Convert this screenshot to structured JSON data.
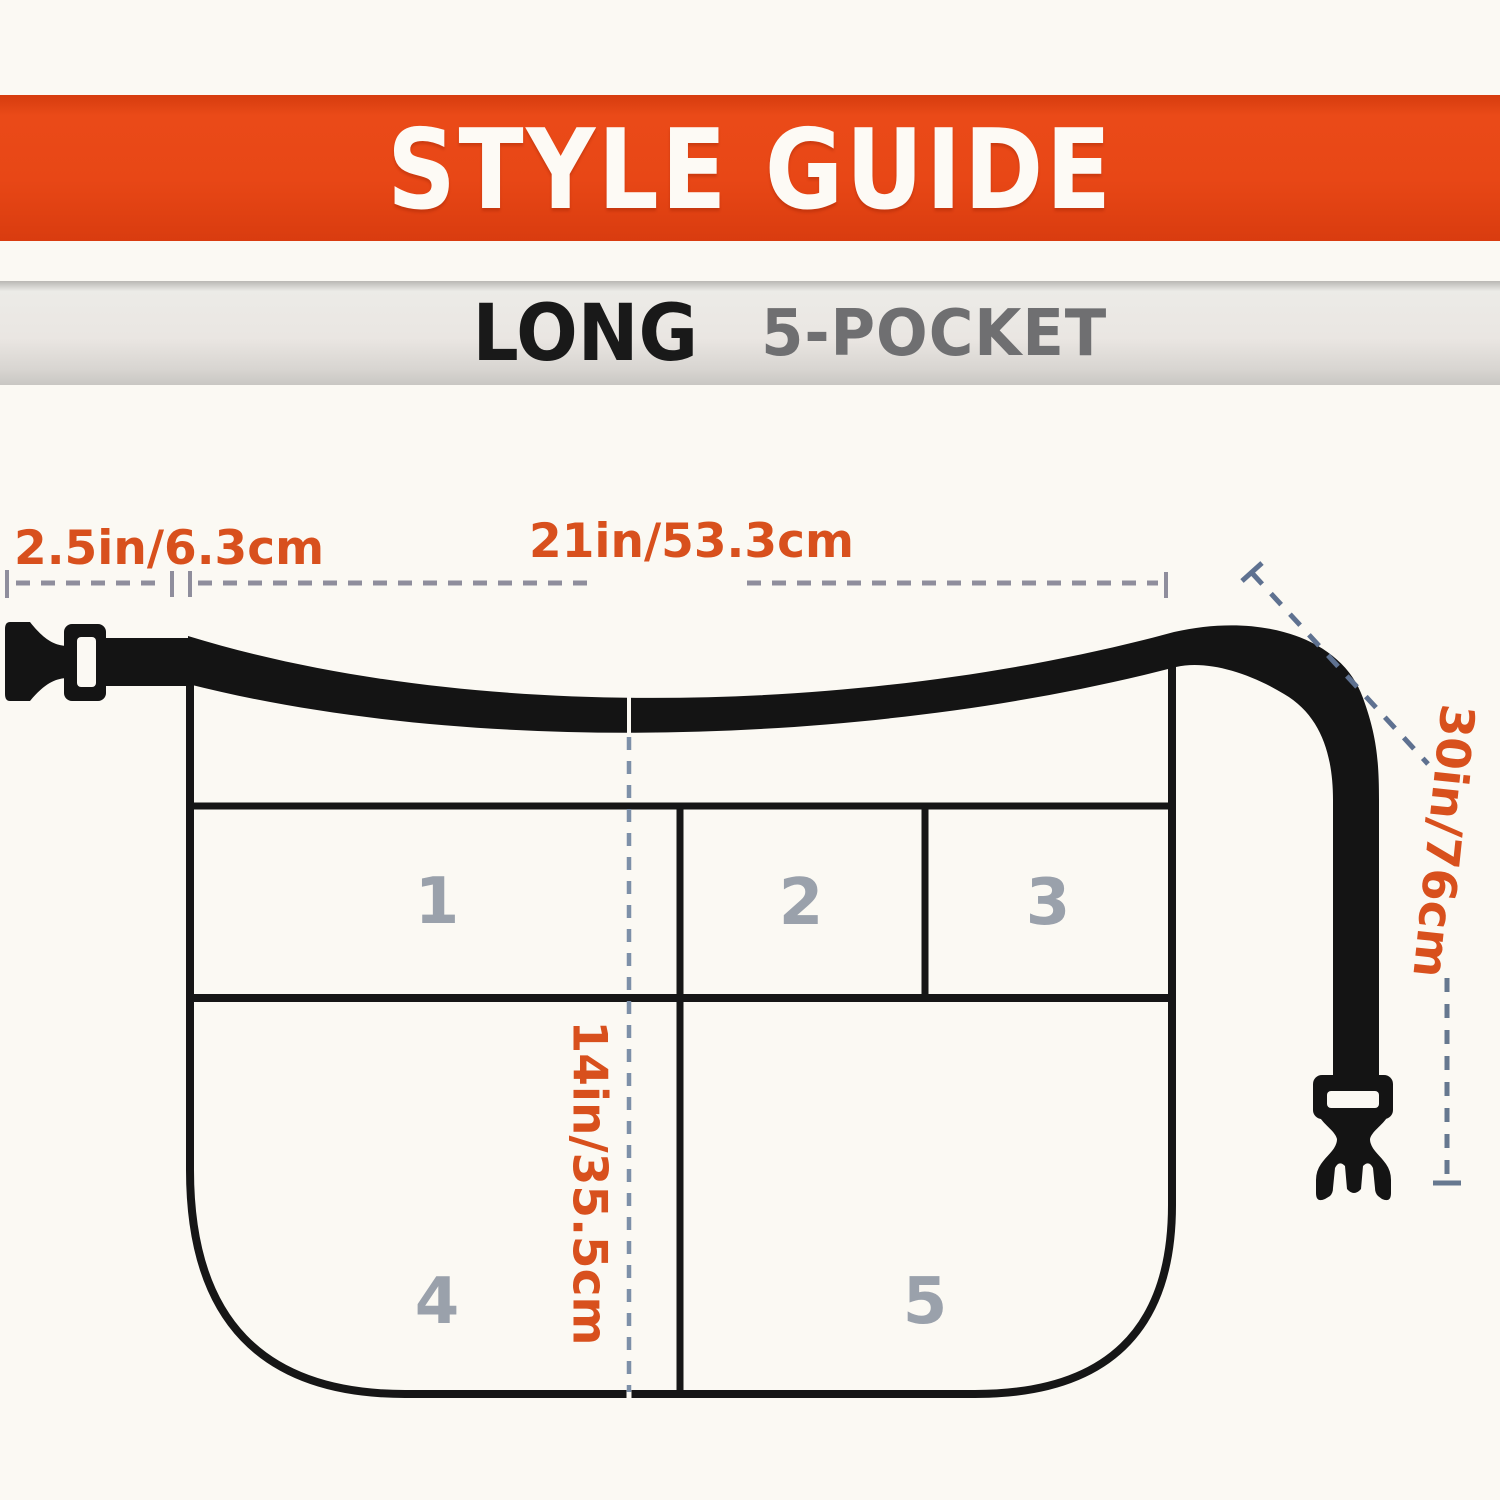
{
  "header": {
    "title": "STYLE GUIDE"
  },
  "subheader": {
    "style_name": "LONG",
    "variant": "5-POCKET"
  },
  "measurements": {
    "strap_offset": "2.5in/6.3cm",
    "top_width": "21in/53.3cm",
    "side_length": "30in/76cm",
    "center_height": "14in/35.5cm"
  },
  "pocket_labels": [
    "1",
    "2",
    "3",
    "4",
    "5"
  ],
  "colors": {
    "banner_orange": "#e84716",
    "banner_gray": "#dcdad5",
    "measurement_orange": "#d8501d",
    "dash_gray": "#8f8e9c",
    "dash_blue": "#5e7190",
    "pocket_number_gray": "#9aa1ab",
    "outline_black": "#161616",
    "title_white": "#fdfaf5",
    "variant_gray": "#6f6f71"
  }
}
